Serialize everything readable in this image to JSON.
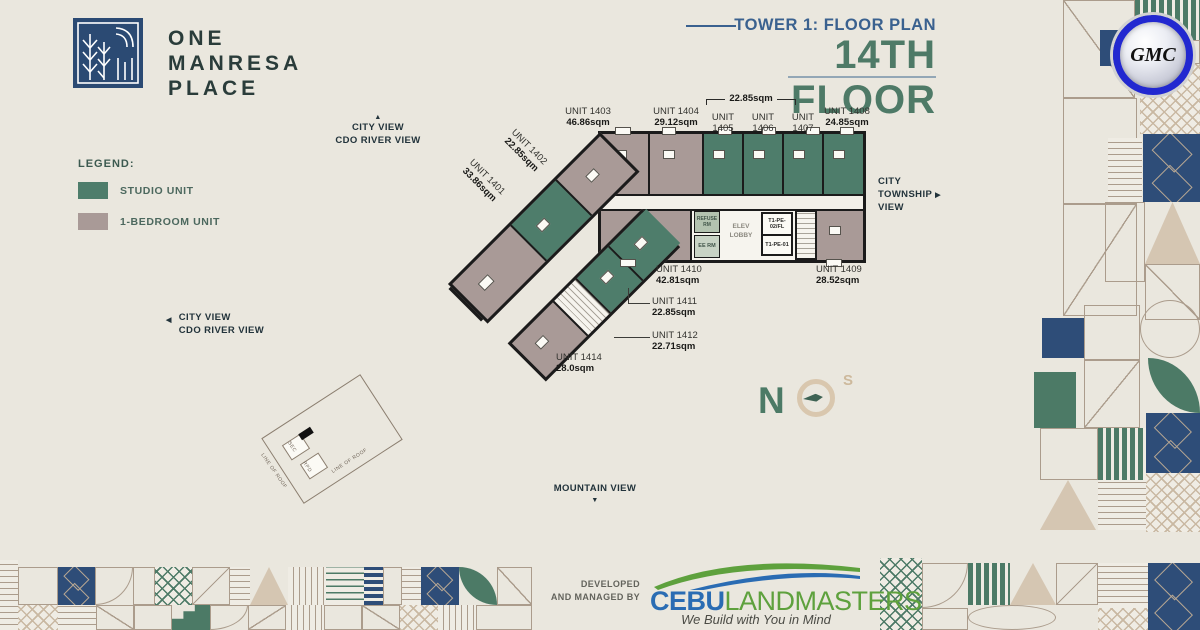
{
  "header": {
    "brand": [
      "ONE",
      "MANRESA",
      "PLACE"
    ],
    "plan_label": "TOWER 1: FLOOR PLAN",
    "floor_title": "14TH FLOOR"
  },
  "badge": "GMC",
  "legend": {
    "title": "LEGEND:",
    "items": [
      {
        "label": "STUDIO UNIT",
        "color": "#4e7d6b"
      },
      {
        "label": "1-BEDROOM UNIT",
        "color": "#a99a97"
      }
    ]
  },
  "views": {
    "top": {
      "arrow": "▲",
      "lines": [
        "CITY VIEW",
        "CDO RIVER VIEW"
      ]
    },
    "right": {
      "arrow": "▶",
      "lines": [
        "CITY",
        "TOWNSHIP",
        "VIEW"
      ]
    },
    "left": {
      "arrow": "◀",
      "lines": [
        "CITY VIEW",
        "CDO RIVER VIEW"
      ]
    },
    "bottom": {
      "arrow": "▼",
      "label": "MOUNTAIN VIEW"
    }
  },
  "compass": {
    "north": "N",
    "south": "S"
  },
  "plan": {
    "bracket_area": "22.85sqm",
    "units": {
      "u1401": {
        "name": "UNIT 1401",
        "area": "33.86sqm",
        "type": "1-bedroom"
      },
      "u1402": {
        "name": "UNIT 1402",
        "area": "22.85sqm",
        "type": "studio"
      },
      "u1403": {
        "name": "UNIT 1403",
        "area": "46.86sqm",
        "type": "1-bedroom"
      },
      "u1404": {
        "name": "UNIT 1404",
        "area": "29.12sqm",
        "type": "1-bedroom"
      },
      "u1405": {
        "name": "UNIT 1405",
        "area": "22.85sqm",
        "type": "studio"
      },
      "u1406": {
        "name": "UNIT 1406",
        "area": "22.85sqm",
        "type": "studio"
      },
      "u1407": {
        "name": "UNIT 1407",
        "area": "22.85sqm",
        "type": "studio"
      },
      "u1408": {
        "name": "UNIT 1408",
        "area": "24.85sqm",
        "type": "studio"
      },
      "u1409": {
        "name": "UNIT 1409",
        "area": "28.52sqm",
        "type": "1-bedroom"
      },
      "u1410": {
        "name": "UNIT 1410",
        "area": "42.81sqm",
        "type": "1-bedroom"
      },
      "u1411": {
        "name": "UNIT 1411",
        "area": "22.85sqm",
        "type": "studio"
      },
      "u1412": {
        "name": "UNIT 1412",
        "area": "22.71sqm",
        "type": "studio"
      },
      "u1414": {
        "name": "UNIT 1414",
        "area": "28.0sqm",
        "type": "1-bedroom"
      }
    },
    "core": {
      "elev_lobby": "ELEV LOBBY",
      "shaft_top": "T1-PE-02/FL",
      "shaft_bottom": "T1-PE-01",
      "ee_room": "EE RM",
      "refuse_room": "REFUSE RM",
      "void": "VOID"
    },
    "roof": {
      "line_of_roof": "LINE OF ROOF",
      "sec": "SEC",
      "rpd": "RPD"
    }
  },
  "footer": {
    "credit_lines": [
      "DEVELOPED",
      "AND MANAGED BY"
    ],
    "logo": {
      "part1": "CEBU",
      "part2": "LANDMASTERS",
      "tagline": "We Build with You in Mind"
    }
  },
  "colors": {
    "background": "#eae7de",
    "studio": "#4e7d6b",
    "one_bedroom": "#a99a97",
    "wall": "#1b1b1b",
    "brand_navy": "#2b4a73",
    "plan_label_blue": "#3a618f",
    "floor_title_green": "#4e7a67",
    "pattern_line": "#ab9c8c",
    "cebu_blue": "#2a6cb3",
    "landmasters_green": "#5ea13d"
  }
}
